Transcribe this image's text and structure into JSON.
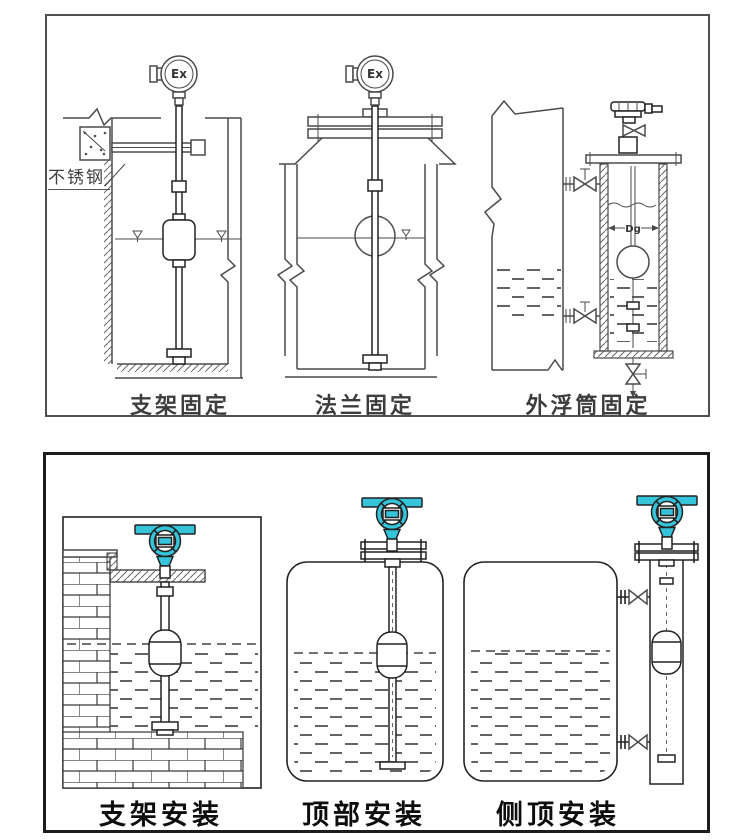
{
  "colors": {
    "teal": "#35c4da",
    "line": "#4a4a4a",
    "ink": "#1c1c1c"
  },
  "top_panel": {
    "device_label": "Ex",
    "figures": [
      {
        "caption": "支架固定",
        "annotation": "不锈钢"
      },
      {
        "caption": "法兰固定"
      },
      {
        "caption": "外浮筒固定",
        "dimension_label": "Dg"
      }
    ]
  },
  "bottom_panel": {
    "figures": [
      {
        "caption": "支架安装"
      },
      {
        "caption": "顶部安装"
      },
      {
        "caption": "侧顶安装"
      }
    ]
  }
}
